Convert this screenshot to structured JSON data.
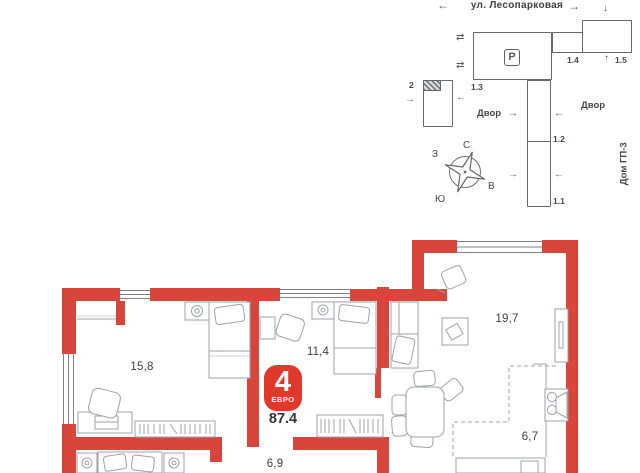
{
  "colors": {
    "wall_red": "#d8453a",
    "badge_red": "#e2382c",
    "furniture_gray": "#9ba2a8",
    "text_dark": "#43474b"
  },
  "icons": {
    "arrow_left": "←",
    "arrow_right": "→",
    "arrow_up": "↑",
    "arrow_down": "↓",
    "arrow_both": "⇄"
  },
  "site_plan": {
    "street": "ул. Лесопарковая",
    "parking": "P",
    "labels": {
      "b2": "2",
      "b13": "1.3",
      "b14": "1.4",
      "b15": "1.5",
      "b12": "1.2",
      "b11": "1.1"
    },
    "courtyard_left": "Двор",
    "courtyard_right": "Двор",
    "house": "Дом ГП-3",
    "compass": {
      "n": "С",
      "e": "В",
      "s": "Ю",
      "w": "З"
    }
  },
  "floor_plan": {
    "areas": {
      "bedroom_large": "15,8",
      "bedroom_small": "11,4",
      "living": "19,7",
      "kitchen_zone": "6,7",
      "hallway": "6,9"
    },
    "badge": {
      "rooms": "4",
      "type": "ЕВРО",
      "total": "87.4"
    }
  }
}
